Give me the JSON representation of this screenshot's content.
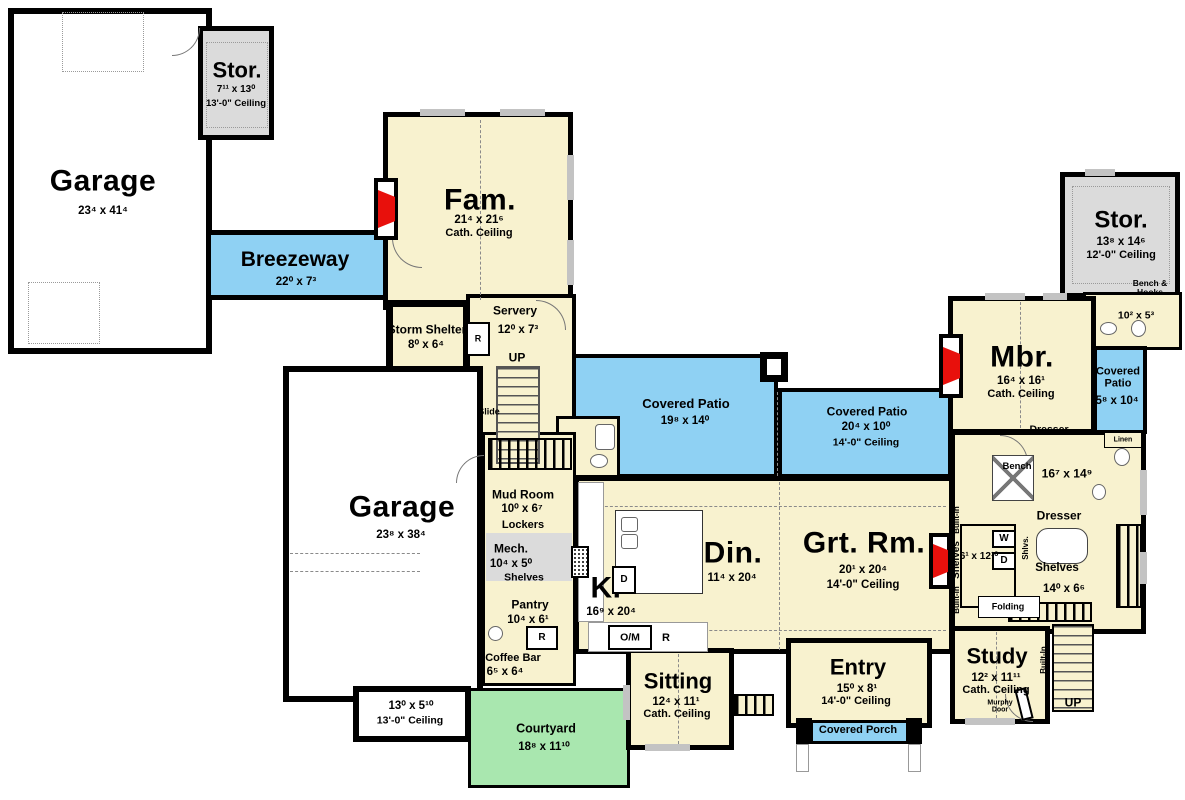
{
  "colors": {
    "room": "#F8F2CF",
    "patio": "#8FD1F3",
    "courtyard": "#A9E7AF",
    "storage": "#DBDBDB",
    "garage": "#FFFFFF",
    "fireplace": "#E8100C",
    "wall": "#000000"
  },
  "rooms": {
    "garage_nw": {
      "name": "Garage",
      "dims": "23⁴ x 41⁴"
    },
    "stor_nw": {
      "name": "Stor.",
      "dims": "7¹¹ x 13⁰",
      "ceiling": "13'-0\" Ceiling"
    },
    "breezeway": {
      "name": "Breezeway",
      "dims": "22⁰ x 7³"
    },
    "fam": {
      "name": "Fam.",
      "dims": "21⁴ x 21⁶",
      "ceiling": "Cath. Ceiling"
    },
    "storm_shelter": {
      "name": "Storm Shelter",
      "dims": "8⁰ x 6⁴"
    },
    "servery": {
      "name": "Servery",
      "dims": "12⁰ x 7³"
    },
    "patio_w": {
      "name": "Covered Patio",
      "dims": "19⁸ x 14⁰"
    },
    "patio_c": {
      "name": "Covered Patio",
      "dims": "20⁴ x 10⁰",
      "ceiling": "14'-0\" Ceiling"
    },
    "patio_e": {
      "name": "Covered Patio",
      "dims": "5⁸ x 10⁴"
    },
    "stor_ne": {
      "name": "Stor.",
      "dims": "13⁸ x 14⁶",
      "ceiling": "12'-0\" Ceiling"
    },
    "bath_ne": {
      "dims": "10² x 5³"
    },
    "mbr": {
      "name": "Mbr.",
      "dims": "16⁴ x 16¹",
      "ceiling": "Cath. Ceiling"
    },
    "mbath": {
      "dims": "16⁷ x 14⁹"
    },
    "wic": {
      "name": "Shelves",
      "dims": "14⁰ x 6⁶"
    },
    "laundry": {
      "dims": "6¹ x 12¹⁰"
    },
    "grt_rm": {
      "name": "Grt. Rm.",
      "dims": "20¹ x 20⁴",
      "ceiling": "14'-0\" Ceiling"
    },
    "din": {
      "name": "Din.",
      "dims": "11⁴ x 20⁴"
    },
    "kitchen": {
      "name": "K.",
      "dims": "16⁹ x 20⁴"
    },
    "mud_room": {
      "name": "Mud Room",
      "dims": "10⁰ x 6⁷"
    },
    "mech": {
      "name": "Mech.",
      "dims": "10⁴ x 5⁰"
    },
    "pantry": {
      "name": "Pantry",
      "dims": "10⁴ x 6¹"
    },
    "coffee_bar": {
      "name": "Coffee Bar",
      "dims": "6⁵ x 6⁴"
    },
    "garage_w": {
      "name": "Garage",
      "dims": "23⁸ x 38⁴"
    },
    "garage_bay": {
      "dims": "13⁰ x 5¹⁰",
      "ceiling": "13'-0\" Ceiling"
    },
    "courtyard": {
      "name": "Courtyard",
      "dims": "18⁸ x 11¹⁰"
    },
    "sitting": {
      "name": "Sitting",
      "dims": "12⁴ x 11¹",
      "ceiling": "Cath. Ceiling"
    },
    "entry": {
      "name": "Entry",
      "dims": "15⁰ x 8¹",
      "ceiling": "14'-0\" Ceiling"
    },
    "covered_porch": {
      "name": "Covered Porch"
    },
    "study": {
      "name": "Study",
      "dims": "12² x 11¹¹",
      "ceiling": "Cath. Ceiling"
    }
  },
  "labels": {
    "up": "UP",
    "slide": "Slide",
    "r": "R",
    "d": "D",
    "w": "W",
    "om": "O/M",
    "built_in": "Built-In",
    "dresser": "Dresser",
    "shelves": "Shelves",
    "linen": "Linen",
    "bench": "Bench",
    "bench_hooks": "Bench & Hooks",
    "shlvs": "Shlvs.",
    "folding": "Folding",
    "lockers": "Lockers",
    "murphy_door": "Murphy Door"
  }
}
